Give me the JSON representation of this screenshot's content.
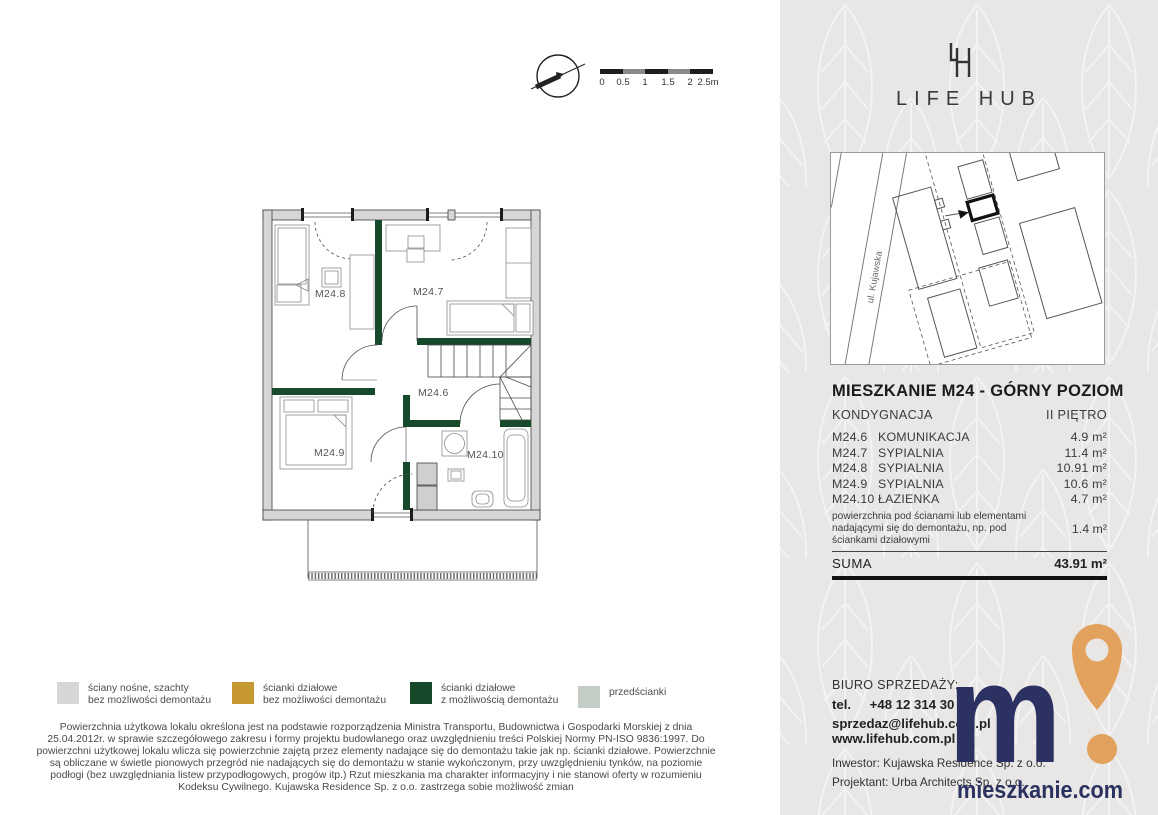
{
  "colors": {
    "wall_gray": "#d6d6d6",
    "partition_gold": "#c5992f",
    "partition_green": "#17492b",
    "pre_wall_gray_green": "#c3ccc5",
    "brand_navy": "#2b3160",
    "brand_orange": "#e2a15c",
    "panel_bg": "#e8e7e5"
  },
  "scalebar": {
    "labels": [
      "0",
      "0.5",
      "1",
      "1.5",
      "2",
      "2.5m"
    ]
  },
  "logo": {
    "wordmark": "LIFE HUB"
  },
  "sitemap": {
    "street_label": "ul. Kujawska"
  },
  "plan": {
    "room_labels": {
      "m24_6": "M24.6",
      "m24_7": "M24.7",
      "m24_8": "M24.8",
      "m24_9": "M24.9",
      "m24_10": "M24.10"
    }
  },
  "unit": {
    "title": "MIESZKANIE M24 - GÓRNY POZIOM",
    "floor_label": "KONDYGNACJA",
    "floor_value": "II PIĘTRO",
    "rooms": [
      {
        "code": "M24.6",
        "name": "KOMUNIKACJA",
        "area": "4.9 m²"
      },
      {
        "code": "M24.7",
        "name": "SYPIALNIA",
        "area": "11.4 m²"
      },
      {
        "code": "M24.8",
        "name": "SYPIALNIA",
        "area": "10.91 m²"
      },
      {
        "code": "M24.9",
        "name": "SYPIALNIA",
        "area": "10.6 m²"
      },
      {
        "code": "M24.10",
        "name": "ŁAZIENKA",
        "area": "4.7 m²"
      }
    ],
    "walls_note": "powierzchnia pod ścianami lub elementami nadającymi się do demontażu, np. pod ściankami działowymi",
    "walls_note_area": "1.4 m²",
    "sum_label": "SUMA",
    "sum_value": "43.91 m²"
  },
  "legend": {
    "items": [
      {
        "line1": "ściany nośne, szachty",
        "line2": "bez możliwości demontażu",
        "color": "#d6d6d6"
      },
      {
        "line1": "ścianki działowe",
        "line2": "bez możliwości demontażu",
        "color": "#c5992f"
      },
      {
        "line1": "ścianki działowe",
        "line2": "z możliwością demontażu",
        "color": "#17492b"
      },
      {
        "line1": "przedścianki",
        "line2": "",
        "color": "#c3ccc5"
      }
    ]
  },
  "disclaimer": "Powierzchnia użytkowa lokalu określona jest na podstawie rozporządzenia Ministra Transportu, Budownictwa i Gospodarki Morskiej z dnia 25.04.2012r. w sprawie szczegółowego zakresu i formy projektu budowlanego oraz uwzględnieniu treści Polskiej Normy PN-ISO 9836:1997. Do powierzchni użytkowej lokalu wlicza się powierzchnie zajętą przez elementy nadające się do demontażu takie jak np. ścianki działowe. Powierzchnie są obliczane w świetle pionowych przegród nie nadających się do demontażu w stanie wykończonym, przy uwzględnieniu tynków, na poziomie podłogi (bez uwzględniania listew przypodłogowych, progów itp.) Rzut mieszkania ma charakter informacyjny i nie stanowi oferty w rozumieniu Kodeksu Cywilnego. Kujawska Residence Sp. z o.o. zastrzega sobie możliwość zmian",
  "contact": {
    "office_label": "BIURO SPRZEDAŻY:",
    "tel_label": "tel.",
    "tel_value": "+48 12 314 30 04",
    "email": "sprzedaz@lifehub.com.pl",
    "separator": "|",
    "www": "www.lifehub.com.pl",
    "investor": "Inwestor: Kujawska Residence Sp. z o.o.",
    "designer": "Projektant:  Urba Architects Sp. z o.o."
  },
  "footer_logo": {
    "wordmark": "mieszkanie.com"
  }
}
